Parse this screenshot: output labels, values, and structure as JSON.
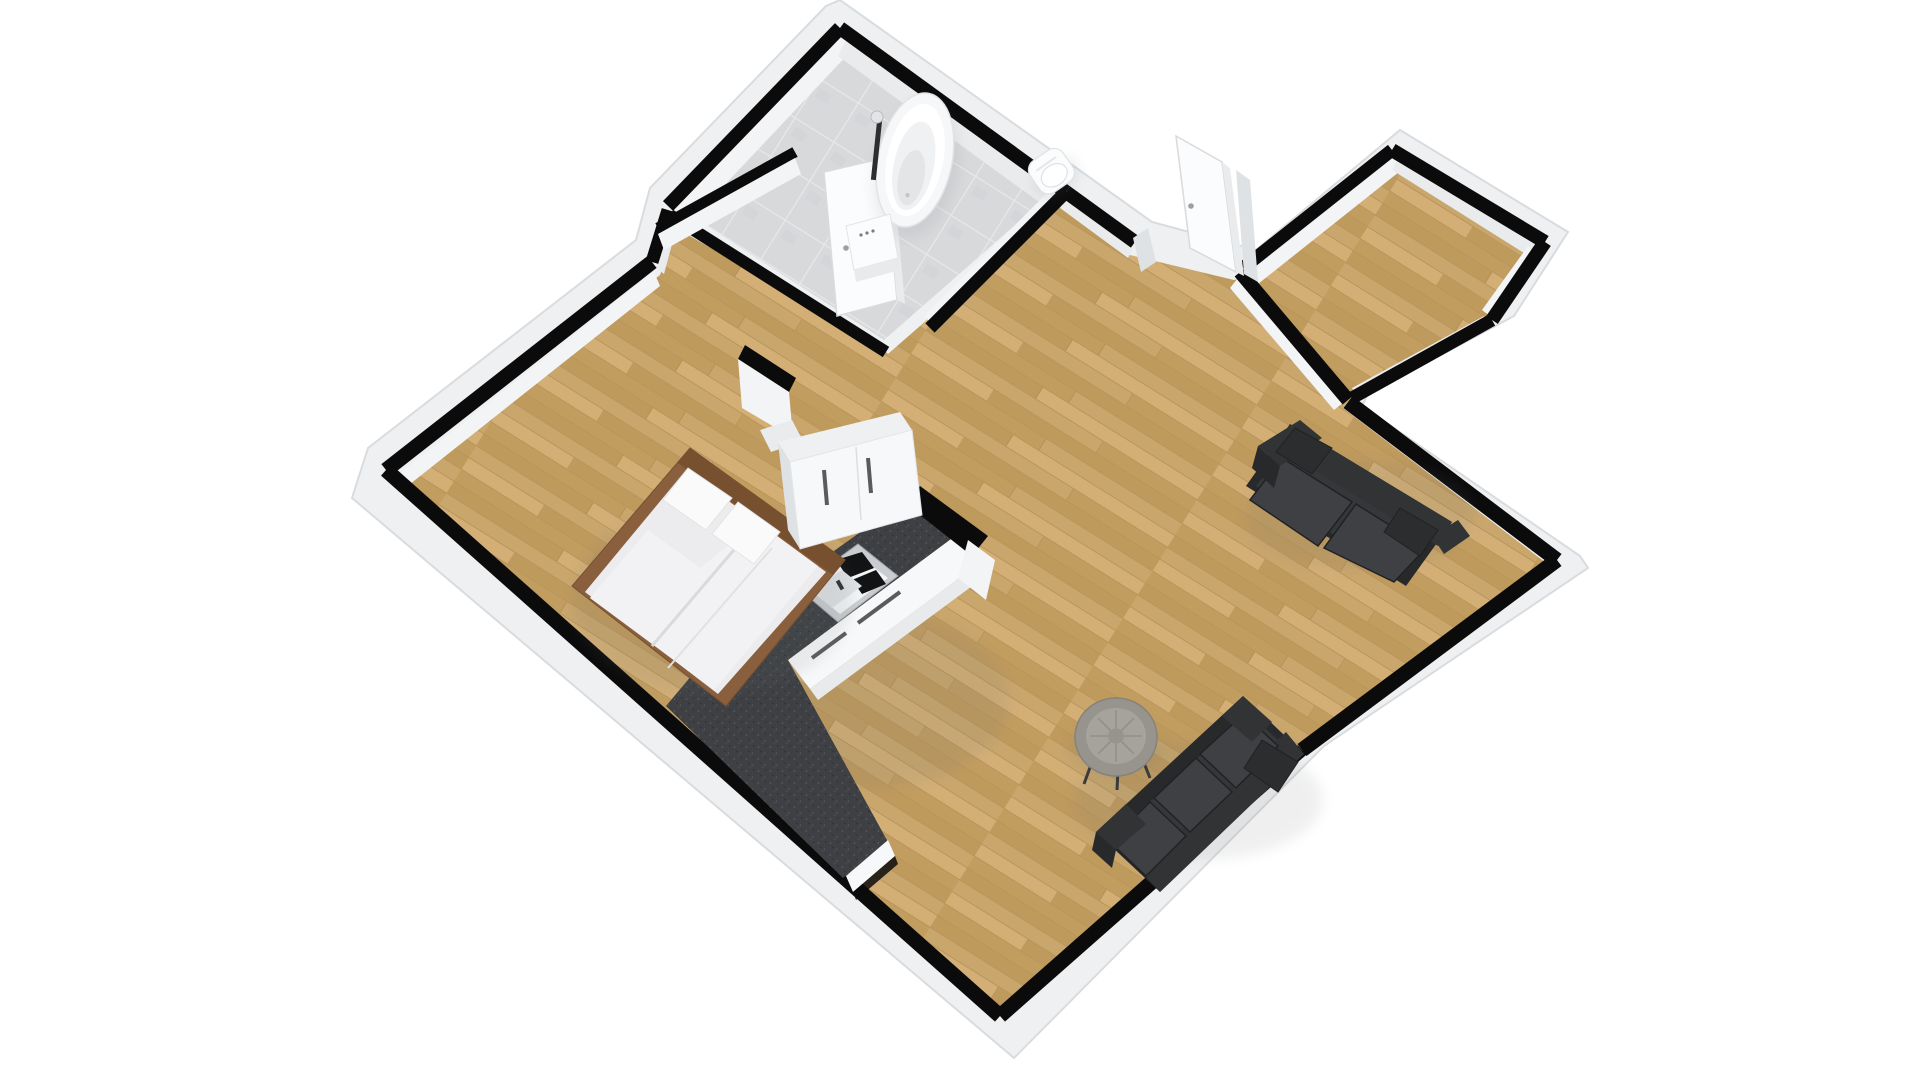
{
  "app": {
    "title": "3D floor plan rendering",
    "view": "isometric overhead",
    "background": "#ffffff"
  },
  "palette": {
    "bg": "#ffffff",
    "slab": "#eef0f2",
    "slabEdge": "#d9dcdf",
    "wallBlack": "#0b0b0c",
    "wallFaceLight": "#f3f4f6",
    "wallFaceMid": "#e9ebed",
    "wallFaceDark": "#dfe2e4",
    "woodA": "#c9a66c",
    "woodB": "#bf9a5d",
    "woodC": "#d3af76",
    "woodD": "#c29d60",
    "woodSeam": "#ab8750",
    "tileBase": "#d7d9db",
    "tileLine": "#e6e8ea",
    "granite": "#3e4043",
    "graniteLight": "#56595d",
    "graniteDark": "#2a2c2e",
    "cabinetWhite": "#f7f8f9",
    "cabinetShade": "#e8eaec",
    "handleDark": "#595c5e",
    "steel": "#c9ccd0",
    "steelDark": "#9fa3a7",
    "fixtureWhite": "#fbfcfd",
    "sofaBase": "#28292b",
    "sofaMid": "#313335",
    "sofaDeck": "#35373a",
    "sofaCushion": "#3e4043",
    "sofaPillow": "#2b2d2f",
    "sofaSeam": "#1f2123",
    "bedFrame": "#8a5f3d",
    "bedFrameDark": "#77502f",
    "mattress": "#ececee",
    "duvet": "#f2f2f4",
    "pillowWhite": "#fafafb",
    "tableTop": "#96948c",
    "tableRing": "#a5a39b",
    "tableSpoke": "#8c8a82",
    "legDark": "#3a3b3c",
    "shadow": "#6b6f73"
  },
  "scene": {
    "rooms": [
      {
        "id": "bathroom",
        "label": "bathroom",
        "floor": "grey tile",
        "fixtures": [
          "freestanding bathtub",
          "floor faucet",
          "wall-hung toilet",
          "small vanity",
          "open door"
        ]
      },
      {
        "id": "hallway",
        "label": "entry hall",
        "floor": "wood",
        "fixtures": [
          "open entry door"
        ]
      },
      {
        "id": "corridor",
        "label": "side corridor",
        "floor": "wood",
        "fixtures": []
      },
      {
        "id": "main-room",
        "label": "living / bedroom studio",
        "floor": "wood",
        "fixtures": []
      }
    ],
    "furniture": [
      {
        "id": "bed",
        "label": "double bed with white bedding and wood frame"
      },
      {
        "id": "wardrobe",
        "label": "white double wardrobe"
      },
      {
        "id": "kitchen-counter",
        "label": "L-shaped kitchen counter, dark granite top, white fronts"
      },
      {
        "id": "kitchen-sink",
        "label": "stainless double sink"
      },
      {
        "id": "sofa-loveseat",
        "label": "charcoal two-seat sofa against right wall"
      },
      {
        "id": "sofa-three-seat",
        "label": "charcoal three-seat sofa against lower-right wall"
      },
      {
        "id": "coffee-table",
        "label": "round grey coffee table"
      }
    ],
    "walls": {
      "style": "black plan outline with white extruded sides",
      "outline_color": "#0b0b0c"
    }
  }
}
